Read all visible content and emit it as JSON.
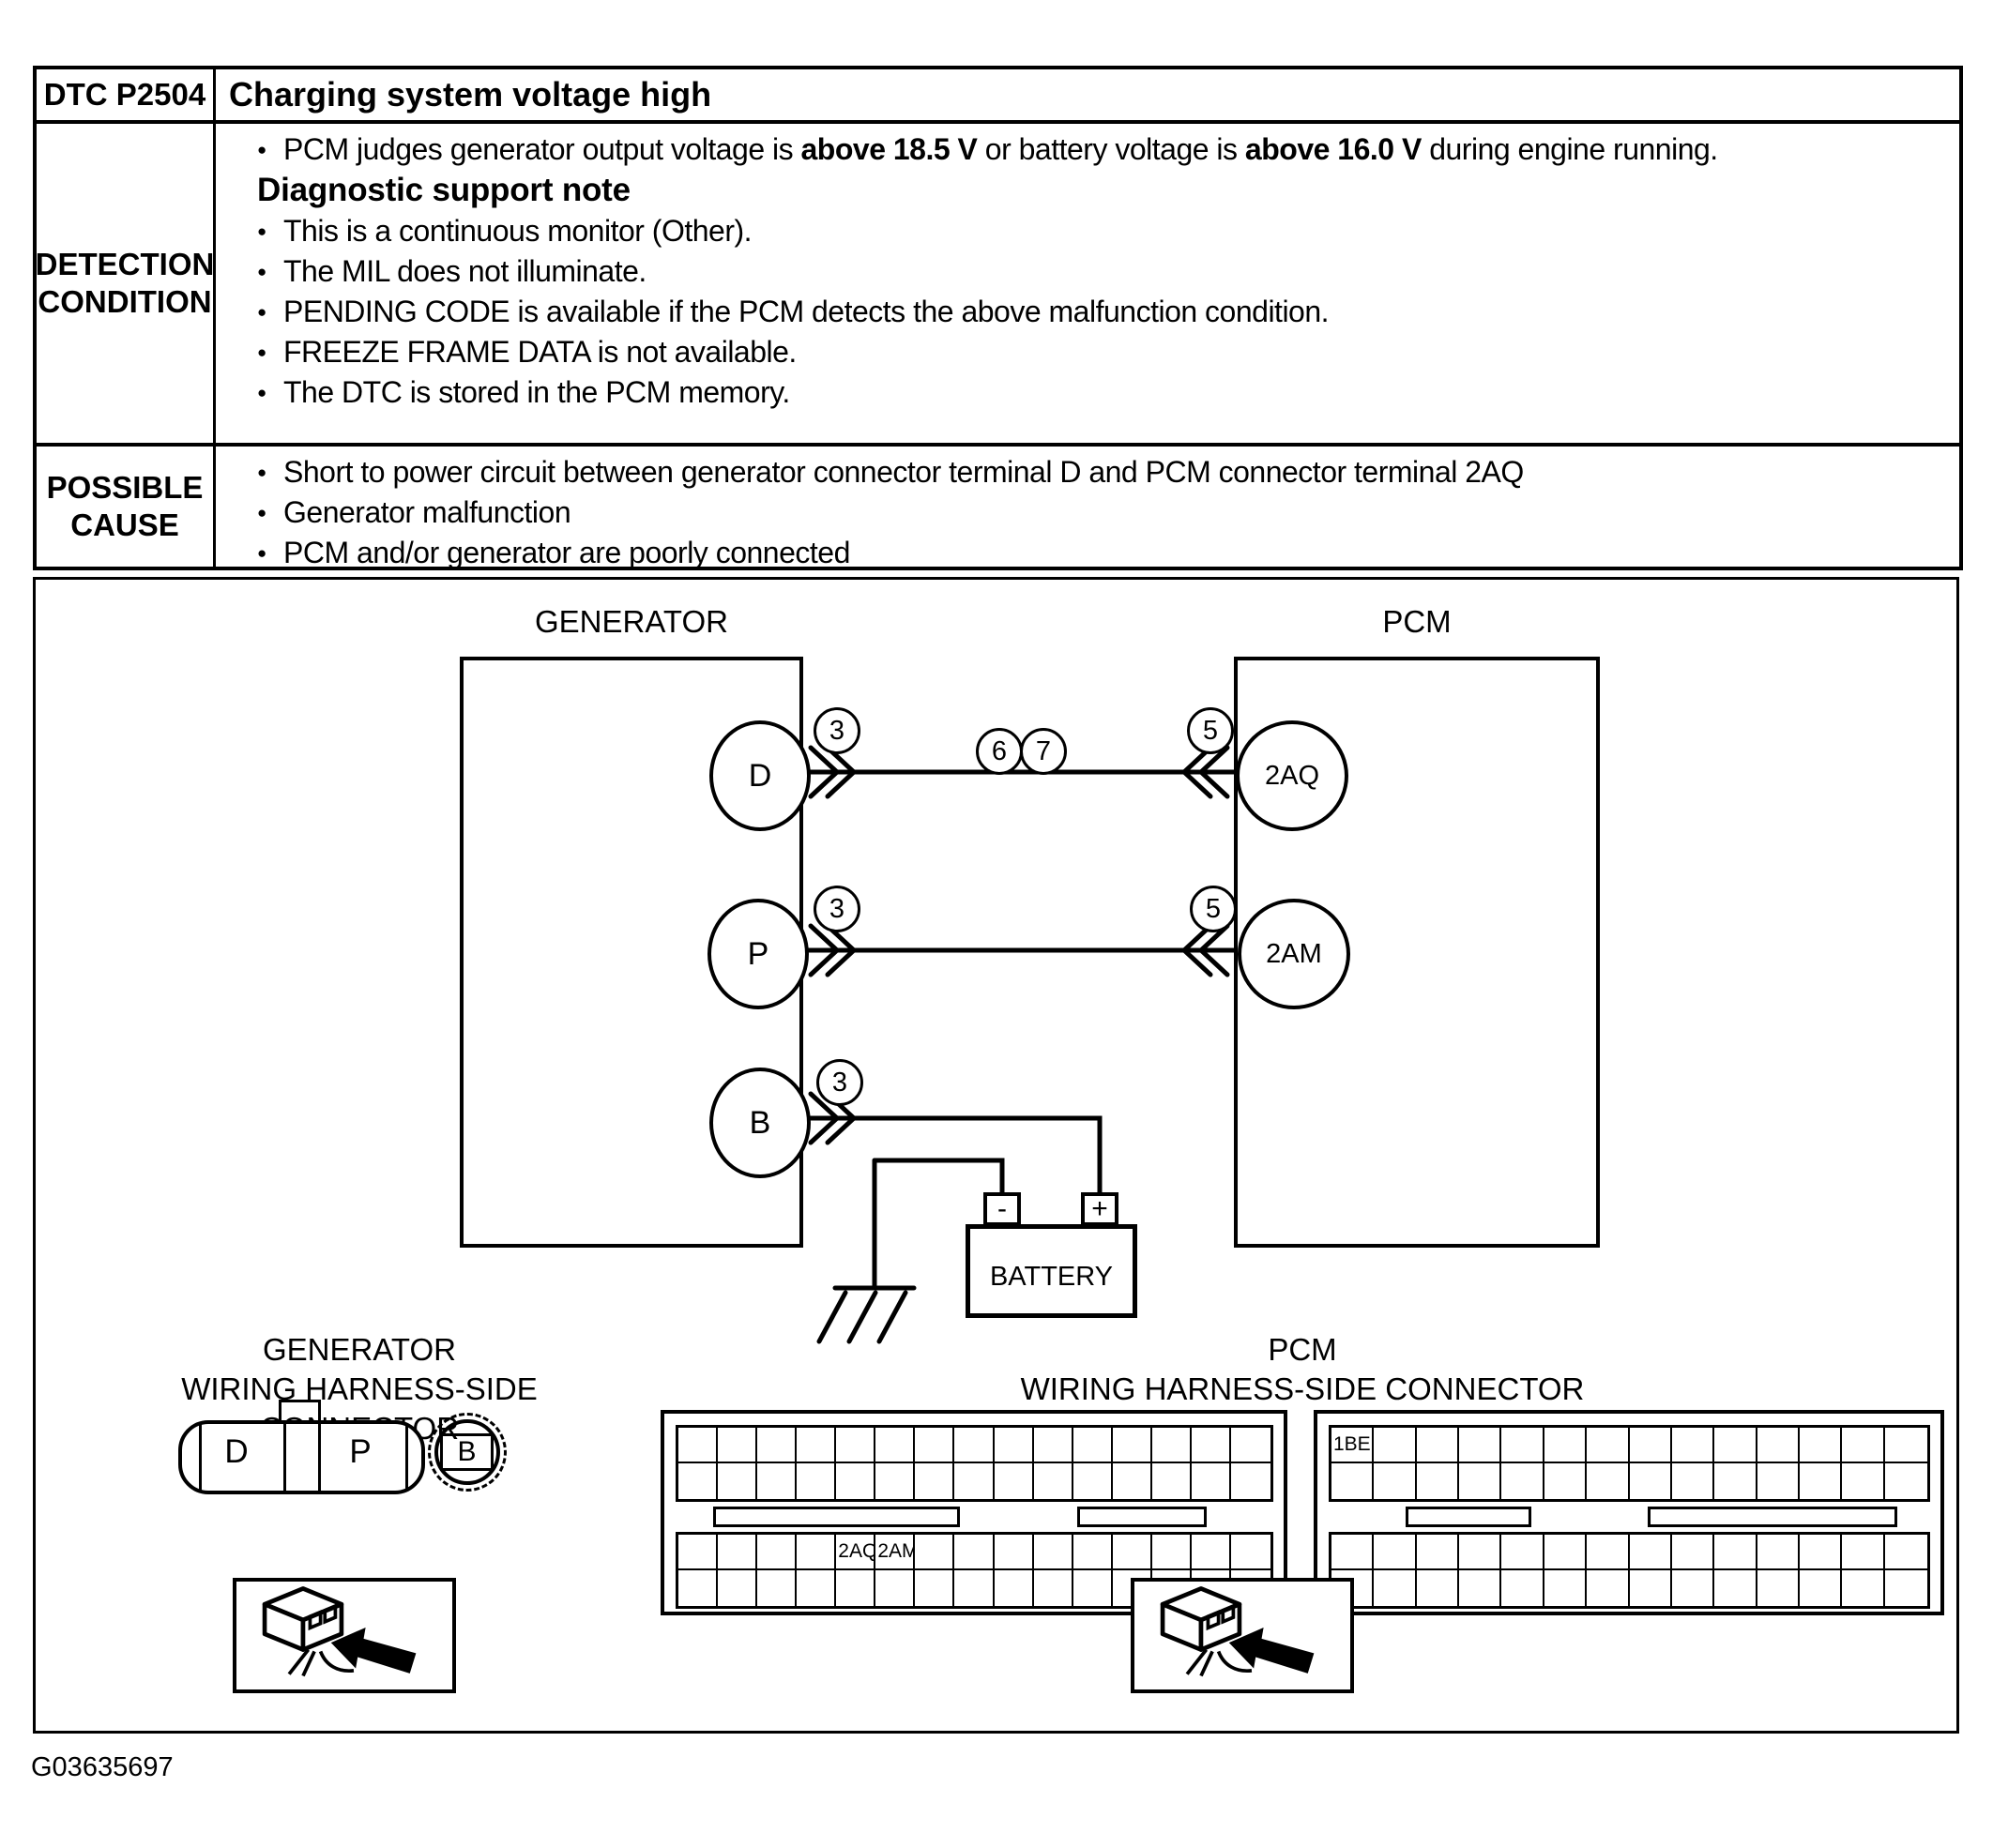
{
  "table": {
    "dtc_label": "DTC P2504",
    "dtc_title": "Charging system voltage high",
    "detection": {
      "row_label_line1": "DETECTION",
      "row_label_line2": "CONDITION",
      "main_bullet": {
        "pre": "PCM judges generator output voltage is ",
        "bold1": "above 18.5 V",
        "mid": " or battery voltage is ",
        "bold2": "above 16.0 V",
        "post": " during engine running."
      },
      "support_heading": "Diagnostic support note",
      "support_bullets": [
        "This is a continuous monitor (Other).",
        "The MIL does not illuminate.",
        "PENDING CODE is available if the PCM detects the above malfunction condition.",
        "FREEZE FRAME DATA is not available.",
        "The DTC is stored in the PCM memory."
      ]
    },
    "possible_cause": {
      "row_label_line1": "POSSIBLE",
      "row_label_line2": "CAUSE",
      "bullets": [
        "Short to power circuit between generator connector terminal D and PCM connector terminal 2AQ",
        "Generator malfunction",
        "PCM and/or generator are poorly connected"
      ]
    }
  },
  "diagram": {
    "generator_label": "GENERATOR",
    "pcm_label": "PCM",
    "terminals": {
      "d": "D",
      "p": "P",
      "b": "B",
      "paq": "2AQ",
      "pam": "2AM"
    },
    "callouts": {
      "three": "3",
      "five": "5",
      "six": "6",
      "seven": "7"
    },
    "battery_label": "BATTERY",
    "battery_minus": "-",
    "battery_plus": "+"
  },
  "connectors": {
    "generator": {
      "title_line1": "GENERATOR",
      "title_line2": "WIRING HARNESS-SIDE CONNECTOR",
      "pin_d": "D",
      "pin_p": "P",
      "pin_b": "B"
    },
    "pcm": {
      "title_line1": "PCM",
      "title_line2": "WIRING HARNESS-SIDE CONNECTOR",
      "left_block": {
        "top_grid": {
          "cols": 15,
          "rows": 2,
          "labels": []
        },
        "bottom_grid": {
          "cols": 15,
          "rows": 2,
          "labels": [
            {
              "r": 0,
              "c": 4,
              "text": "2AQ"
            },
            {
              "r": 0,
              "c": 5,
              "text": "2AM"
            }
          ]
        }
      },
      "right_block": {
        "top_grid": {
          "cols": 14,
          "rows": 2,
          "labels": [
            {
              "r": 0,
              "c": 0,
              "text": "1BE"
            }
          ]
        },
        "bottom_grid": {
          "cols": 14,
          "rows": 2,
          "labels": []
        }
      }
    }
  },
  "footer": {
    "figure_id": "G03635697"
  }
}
